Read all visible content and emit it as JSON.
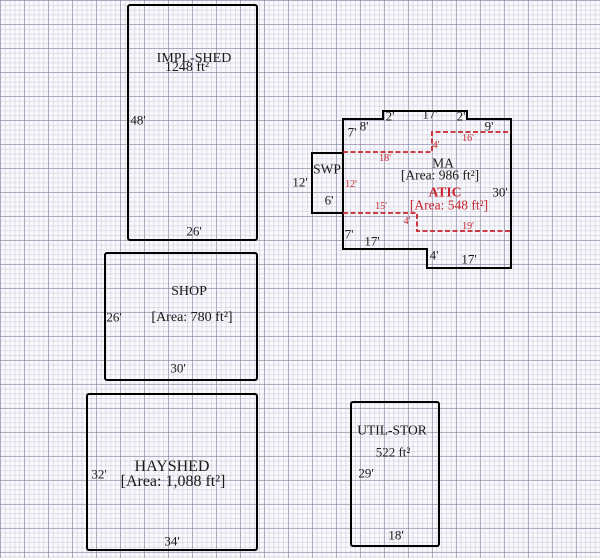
{
  "sketch": {
    "type": "property-sketch-floorplan",
    "colors": {
      "wall_outline": "#000000",
      "attic_overlay": "#c8232c",
      "text": "#1a1a1a",
      "grid_minor": "#d9d9e6",
      "grid_major": "#b3b3c4",
      "paper": "#f9f9fc"
    },
    "buildings": {
      "impl_shed": {
        "label": "IMPL-SHED",
        "area": "1248 ft²",
        "height_ft": "48'",
        "width_ft": "26'"
      },
      "shop": {
        "label": "SHOP",
        "area": "[Area: 780 ft²]",
        "height_ft": "26'",
        "width_ft": "30'"
      },
      "hayshed": {
        "label": "HAYSHED",
        "area": "[Area: 1,088 ft²]",
        "height_ft": "32'",
        "width_ft": "34'"
      },
      "util_stor": {
        "label": "UTIL-STOR",
        "area": "522 ft²",
        "height_ft": "29'",
        "width_ft": "18'"
      },
      "swp": {
        "label": "SWP",
        "height_ft": "12'",
        "width_ft": "6'"
      },
      "ma": {
        "label": "MA",
        "area": "[Area: 986 ft²]",
        "dims": {
          "top_left_height": "7'",
          "top_left_width": "8'",
          "top_step_left": "2'",
          "top_width": "17'",
          "top_step_right": "2'",
          "top_right_width": "9'",
          "right_height": "30'",
          "bottom_left_height": "7'",
          "bottom_left_width": "17'",
          "bottom_step": "4'",
          "bottom_right_width": "17'"
        }
      },
      "atic": {
        "label": "ATIC",
        "area": "[Area: 548 ft²]",
        "dims": {
          "top_left": "18'",
          "top_step": "4'",
          "top_right": "16'",
          "left_height": "12'",
          "bottom_left": "15'",
          "bottom_step": "4'",
          "bottom_right": "19'"
        }
      }
    }
  }
}
